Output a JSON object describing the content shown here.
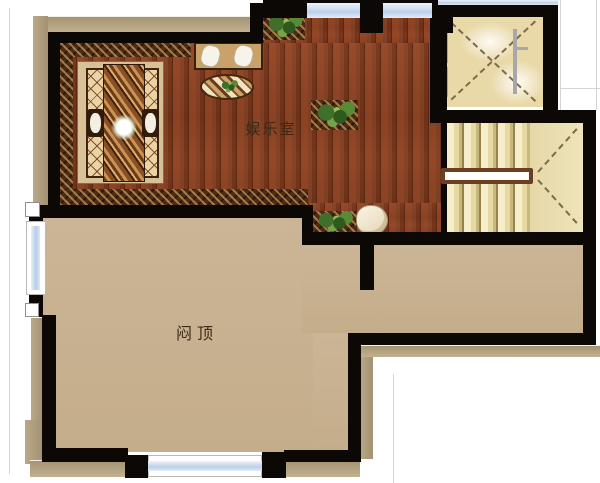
{
  "floorplan": {
    "room_labels": {
      "entertainment": "娱乐室",
      "attic": "闷顶"
    },
    "features": {
      "elevator": "elevator-shaft-with-cross",
      "stairs": "staircase-with-handrail",
      "windows": 5
    },
    "colors": {
      "wall": "#0c0805",
      "wood_floor": "#8a4225",
      "wood_border": "#4e2c14",
      "attic_floor": "#c8b291",
      "stair_floor": "#ede0b3",
      "elevator_floor": "#e9d9a8",
      "shadow": "#b2a181",
      "window_glass": "#c6d7ea",
      "handrail": "#6b4022",
      "background": "#ffffff",
      "label_text": "#3a2a18"
    }
  }
}
